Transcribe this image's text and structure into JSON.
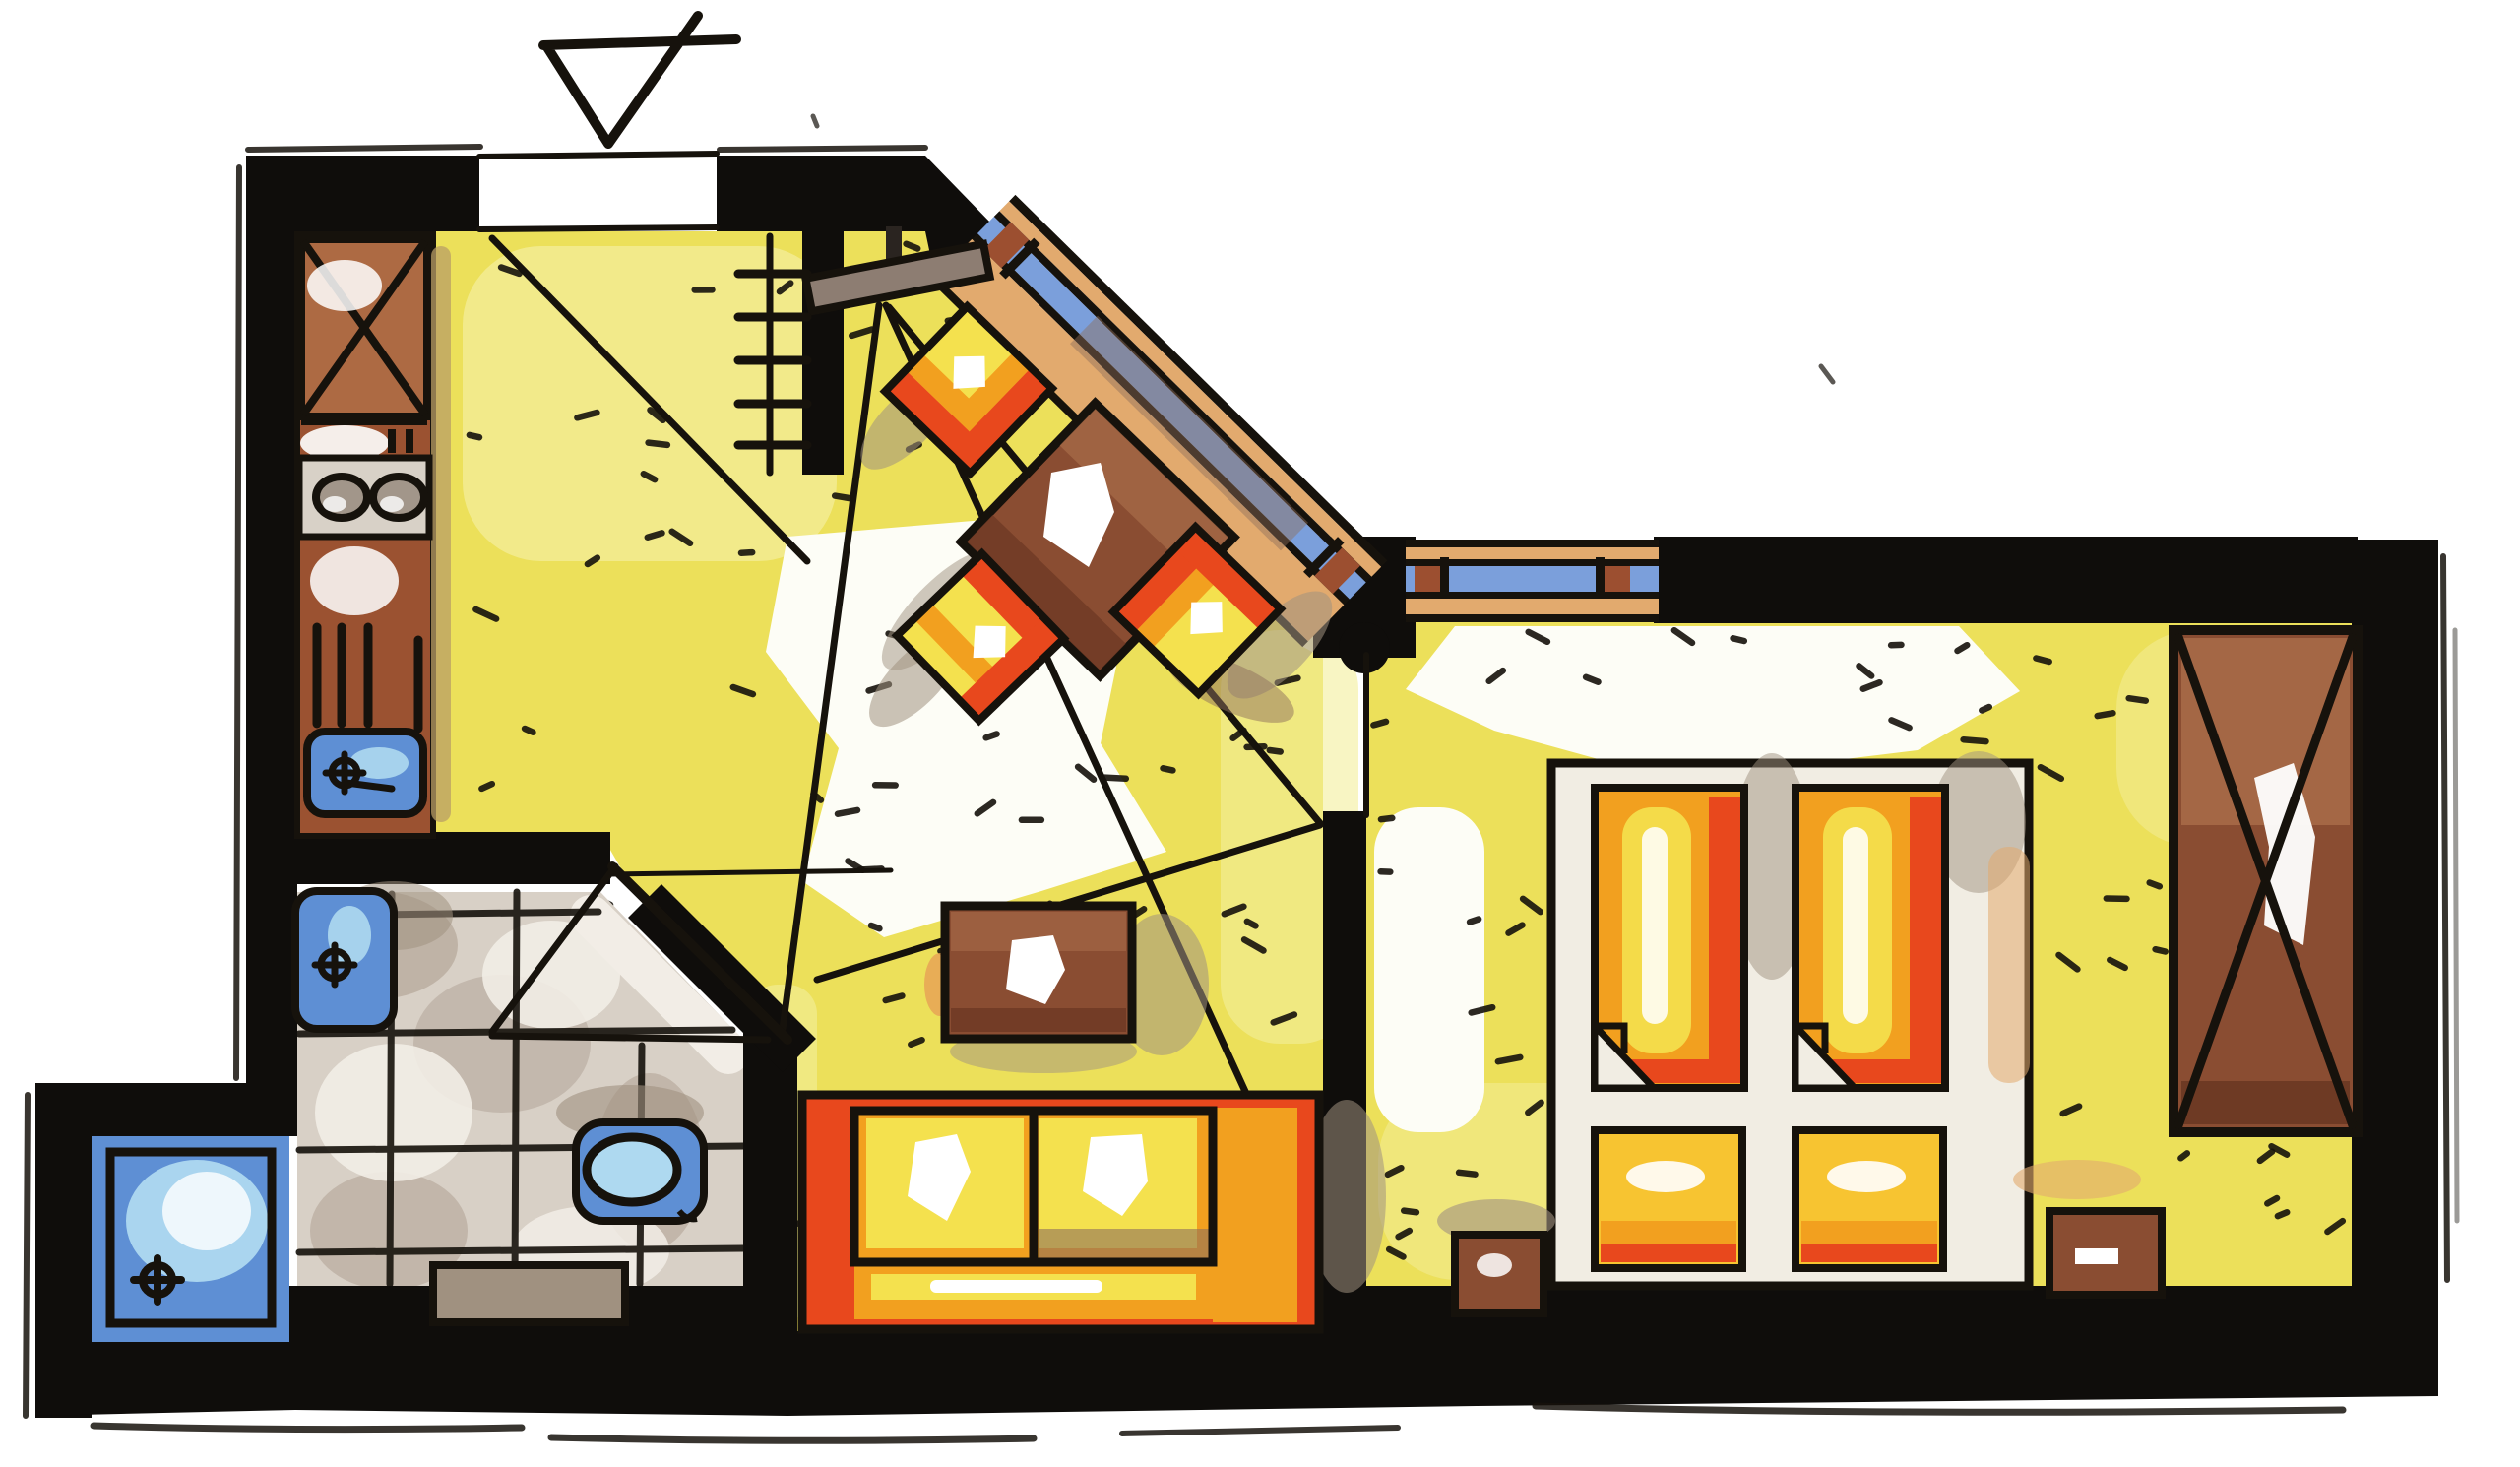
{
  "document": {
    "kind": "hand-drawn marker floor plan",
    "description": "One-bedroom apartment plan rendered with markers: yellow floors, black walls, orange furniture, blue fixtures. No text labels appear in the drawing."
  },
  "palette": {
    "paper": "#ffffff",
    "ink": "#16120c",
    "wall": "#0f0d0b",
    "floor": "#ece05a",
    "floorLight": "#f4ee9b",
    "floorWhite": "#fdfdf6",
    "tile": "#d8d0c6",
    "tileBlotch": "#ab9b8d",
    "tileWhite": "#f2ede6",
    "counter": "#9b5231",
    "counterLight": "#ad6a43",
    "counterShadow": "#b99f66",
    "stove": "#d8d1c7",
    "burner": "#a2968a",
    "fixtureBlue": "#5e8fd4",
    "fixtureLight": "#aed9f0",
    "glassBlue": "#7b9fdb",
    "sillTan": "#e2aa6e",
    "mullion": "#9c4f30",
    "wood": "#8a4d32",
    "woodLight": "#a86c49",
    "woodDark": "#6e3a24",
    "orange": "#f2a01f",
    "yellow": "#f4e14e",
    "pillowYellow": "#f7c431",
    "red": "#e8481d",
    "cream": "#f1ede3",
    "shadow": "#a09180",
    "shadowBrown": "#8d6f5c",
    "rack": "#8d7d72",
    "stem": "#2a2420"
  },
  "inventory": {
    "entrance": [
      "entrance-marker-triangle",
      "door-opening",
      "door-swing-line",
      "coat-rack",
      "radiator"
    ],
    "kitchen": [
      "tall-cabinet-x",
      "counter",
      "stove-2-burners",
      "dish-rack",
      "sink"
    ],
    "bathroom": [
      "washbasin",
      "toilet",
      "bath-mat",
      "angled-door",
      "tiled-floor"
    ],
    "shower_room": [
      "shower-tray",
      "drain"
    ],
    "living_dining": [
      "sofa-2-cushions",
      "coffee-table",
      "dining-table",
      "dining-chairs-x3",
      "angled-corner-window",
      "sight-lines"
    ],
    "bedroom": [
      "twin-bed-platform",
      "duvets-x2",
      "pillows-x2",
      "nightstands-x2",
      "wardrobe-x",
      "window"
    ],
    "counts": {
      "burners": 2,
      "dining_chairs": 3,
      "beds": 2,
      "nightstands": 2
    }
  }
}
